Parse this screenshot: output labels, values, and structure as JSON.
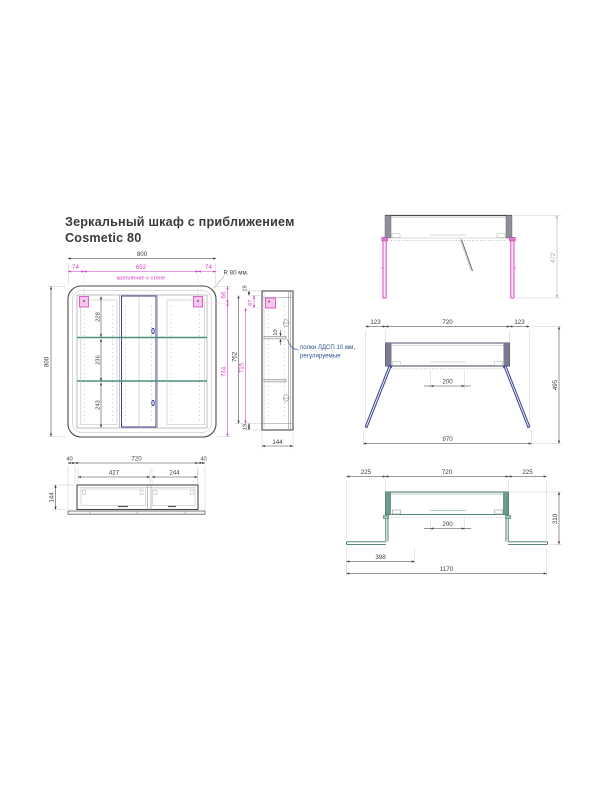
{
  "title": {
    "line1": "Зеркальный шкаф с приближением",
    "line2": "Cosmetic 80"
  },
  "colors": {
    "outline": "#4a4a4a",
    "dimension_text": "#3d3d3d",
    "magenta_accent": "#d83ec4",
    "navy_doors": "#3c4090",
    "teal_shelves": "#4d8d7c",
    "teal_view": "#3f7567",
    "note_blue": "#2d4f8a",
    "gray_dim": "#9aacac"
  },
  "views": {
    "front": {
      "width_total": "800",
      "mount_left": "74",
      "mount_span": "652",
      "mount_right": "74",
      "mount_label": "крепление к стене",
      "corner_radius_label": "R 80 мм.",
      "height_total": "800",
      "top_to_bracket": "66",
      "bracket_to_bottom": "734",
      "section_top": "228",
      "section_middle": "236",
      "section_bottom": "243"
    },
    "side": {
      "top_panel": "19",
      "bracket_offset": "47",
      "inner_height": "762",
      "mount_height": "715",
      "shelf_thickness": "10",
      "bottom_panel": "19",
      "depth": "144",
      "shelf_note_line1": "полки ЛДСП 10 мм,",
      "shelf_note_line2": "регулируемые"
    },
    "top_doors_open_90": {
      "depth_open": "472"
    },
    "top_doors_open_angled": {
      "side_left": "123",
      "body": "720",
      "side_right": "123",
      "handle_zone": "200",
      "total_width": "970",
      "depth_open": "495"
    },
    "bottom_plan": {
      "edge_left": "40",
      "body": "720",
      "edge_right": "40",
      "door_left": "427",
      "door_right": "244",
      "depth": "144"
    },
    "top_doors_open_flat": {
      "side_left": "225",
      "body": "720",
      "side_right": "225",
      "handle_zone": "200",
      "door_width": "398",
      "total_width": "1170",
      "depth_open": "310"
    }
  }
}
